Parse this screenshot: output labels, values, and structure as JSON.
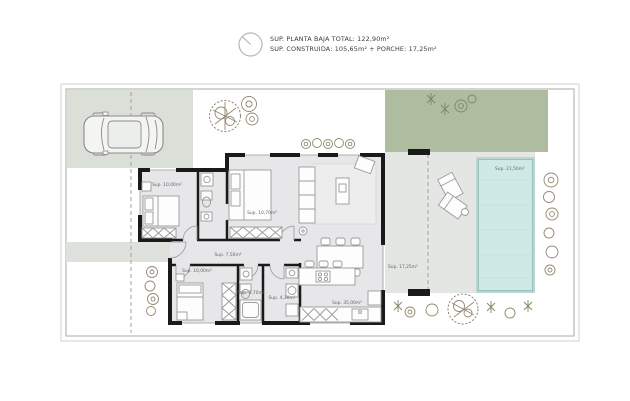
{
  "header": {
    "compass_icon": "north-indicator",
    "line1": "SUP. PLANTA BAJA TOTAL: 122,90m²",
    "line2": "SUP. CONSTRUIDA: 105,65m² + PORCHE: 17,25m²"
  },
  "rooms": {
    "bedroom1": {
      "label": "Sup. 10,00m²"
    },
    "bedroom2": {
      "label": "Sup. 10,70m²"
    },
    "bedroom3": {
      "label": "Sup. 10,00m²"
    },
    "hallway": {
      "label": "Sup. 7,50m²"
    },
    "bathroom": {
      "label": "Sup. 3,70m²"
    },
    "laundry": {
      "label": "Sup. 4,30m²"
    },
    "kitchen_living": {
      "label": "Sup. 35,00m²"
    },
    "porch": {
      "label": "Sup. 17,25m²"
    },
    "pool": {
      "label": "Sup. 21,50m²"
    }
  },
  "colors": {
    "gravel": "#d3c4b1",
    "lawn": "#aebc9f",
    "driveway": "#dadfd7",
    "walkway": "#dfe2dc",
    "terrace": "#e4e6e3",
    "house_floor": "#e7e7e9",
    "pool_water": "#cfeae6",
    "pool_edge": "#8fb5b0",
    "walls": "#1a1a1a"
  }
}
